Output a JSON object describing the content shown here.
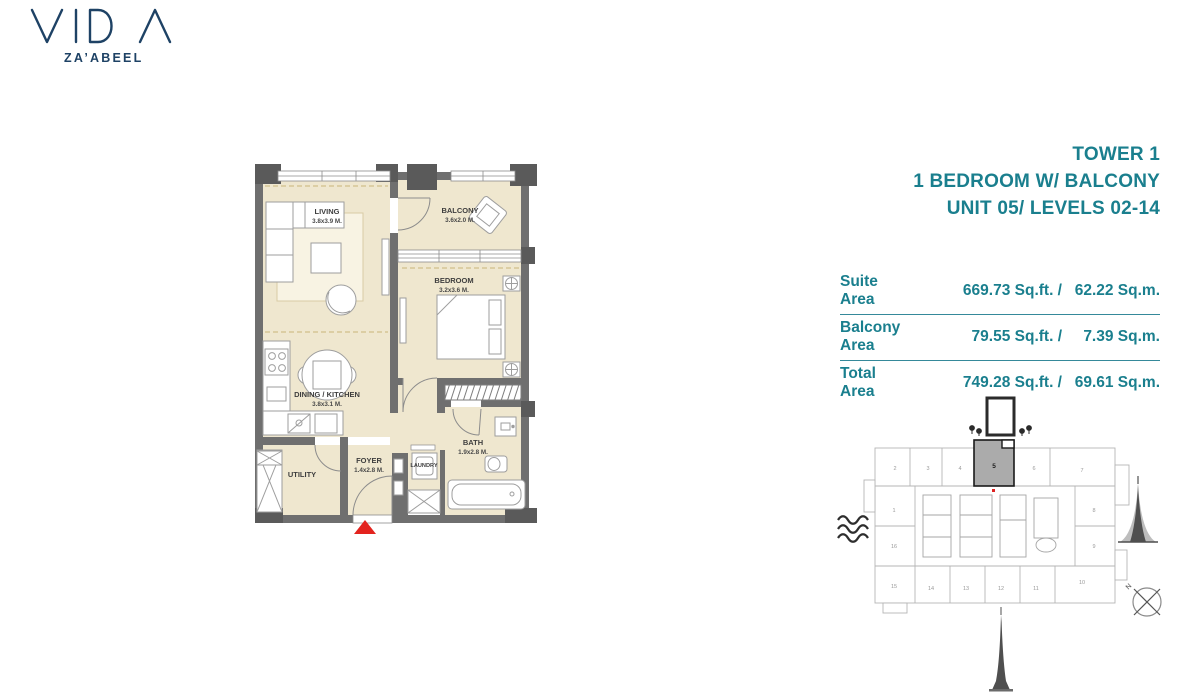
{
  "brand": {
    "name": "VIDA",
    "location": "ZA’ABEEL"
  },
  "header": {
    "line1": "TOWER 1",
    "line2": "1 BEDROOM W/ BALCONY",
    "line3": "UNIT 05/ LEVELS 02-14"
  },
  "area_table": {
    "rows": [
      {
        "label": "Suite Area",
        "sqft": "669.73 Sq.ft. /",
        "sqm": "62.22 Sq.m."
      },
      {
        "label": "Balcony Area",
        "sqft": "79.55 Sq.ft. /",
        "sqm": "7.39 Sq.m."
      },
      {
        "label": "Total Area",
        "sqft": "749.28 Sq.ft. /",
        "sqm": "69.61 Sq.m."
      }
    ]
  },
  "floor_plan": {
    "rooms": [
      {
        "name": "LIVING",
        "dims": "3.8x3.9 M."
      },
      {
        "name": "BALCONY",
        "dims": "3.6x2.0 M."
      },
      {
        "name": "BEDROOM",
        "dims": "3.2x3.6 M."
      },
      {
        "name": "DINING / KITCHEN",
        "dims": "3.8x3.1 M."
      },
      {
        "name": "UTILITY",
        "dims": ""
      },
      {
        "name": "FOYER",
        "dims": "1.4x2.8 M."
      },
      {
        "name": "LAUNDRY",
        "dims": ""
      },
      {
        "name": "BATH",
        "dims": "1.9x2.8 M."
      }
    ]
  },
  "key_plan": {
    "highlighted_unit": "5",
    "top_units": [
      "2",
      "3",
      "4",
      "6",
      "7"
    ],
    "left_units": [
      "1",
      "16"
    ],
    "right_units": [
      "8",
      "9"
    ],
    "bottom_units": [
      "15",
      "14",
      "13",
      "12",
      "11",
      "10"
    ],
    "compass_label": "N"
  },
  "colors": {
    "accent_teal": "#1a7f8e",
    "brand_navy": "#1e4265",
    "plan_room_fill": "#efe7cf",
    "wall_gray": "#6f6f6f",
    "column_gray": "#5a5a5a",
    "unit_highlight_gray": "#a9a9a9",
    "entrance_red": "#e3231e"
  }
}
